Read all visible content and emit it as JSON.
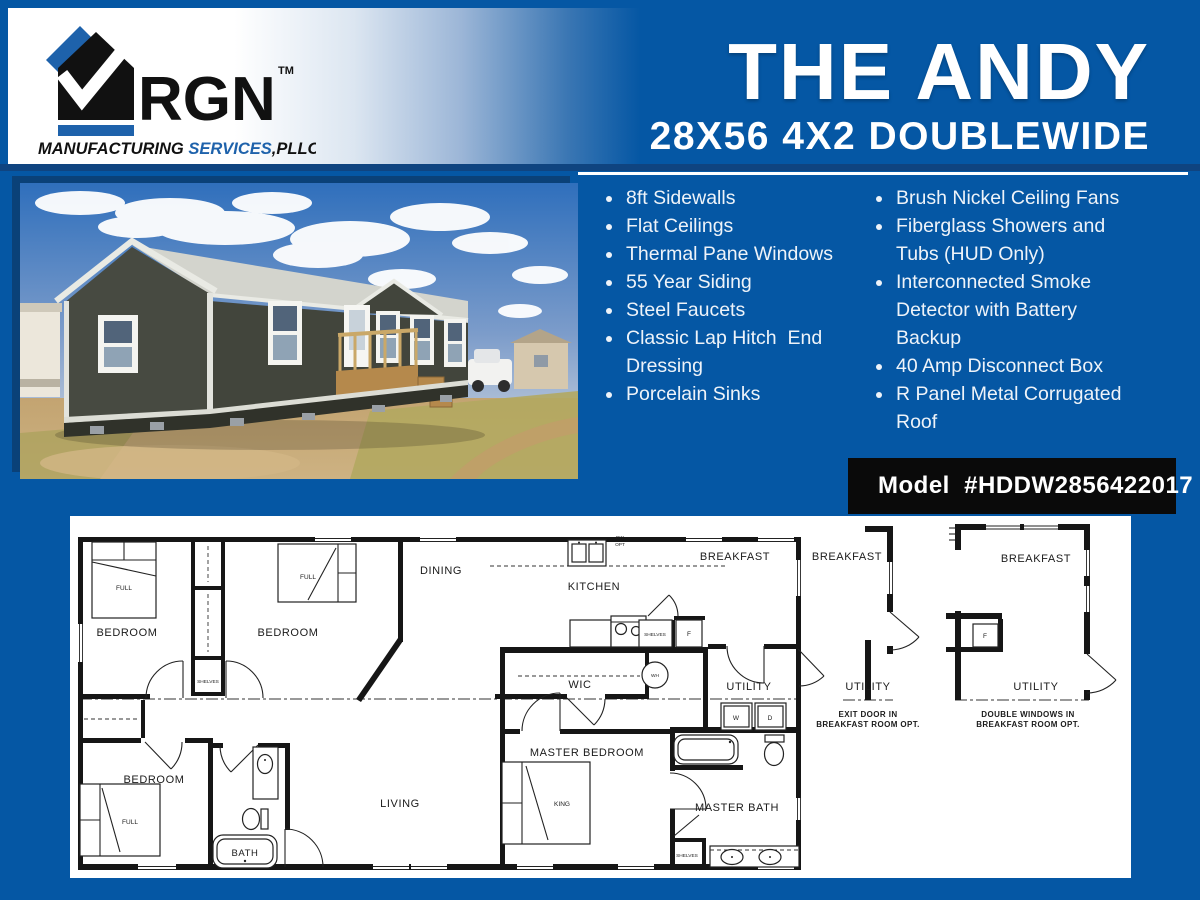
{
  "colors": {
    "background": "#0557a4",
    "navy_rule": "#0f4480",
    "badge_bg": "#0a0a0a",
    "logo_blue": "#1e62ab",
    "text_white": "#ffffff"
  },
  "logo": {
    "brand": "RGN",
    "tm": "TM",
    "tagline_black": "MANUFACTURING ",
    "tagline_blue": "SERVICES",
    "tagline_suffix": ",PLLC"
  },
  "header": {
    "title": "THE ANDY",
    "subtitle": "28X56 4X2 DOUBLEWIDE"
  },
  "features": {
    "left": [
      "8ft Sidewalls",
      "Flat Ceilings",
      "Thermal Pane Windows",
      "55 Year Siding",
      "Steel Faucets",
      "Classic Lap Hitch  End Dressing",
      "Porcelain Sinks"
    ],
    "right": [
      "Brush Nickel Ceiling Fans",
      "Fiberglass Showers and Tubs (HUD Only)",
      "Interconnected Smoke Detector with Battery Backup",
      "40 Amp Disconnect Box",
      "R Panel Metal Corrugated Roof"
    ]
  },
  "model_badge": {
    "label": "Model  #HDDW2856422017"
  },
  "floorplan": {
    "labels": {
      "bedroom": "BEDROOM",
      "dining": "DINING",
      "kitchen": "KITCHEN",
      "breakfast": "BREAKFAST",
      "utility": "UTILITY",
      "wic": "WIC",
      "living": "LIVING",
      "bath": "BATH",
      "master_bedroom": "MASTER BEDROOM",
      "master_bath": "MASTER BATH",
      "shelves": "SHELVES",
      "full": "FULL",
      "king": "KING",
      "fridge": "F",
      "water_heater": "WH",
      "washer": "W",
      "dryer": "D",
      "dw": "DW",
      "opt": "OPT"
    },
    "captions": {
      "opt1_line1": "EXIT DOOR IN",
      "opt1_line2": "BREAKFAST ROOM OPT.",
      "opt2_line1": "DOUBLE WINDOWS IN",
      "opt2_line2": "BREAKFAST ROOM OPT."
    }
  }
}
